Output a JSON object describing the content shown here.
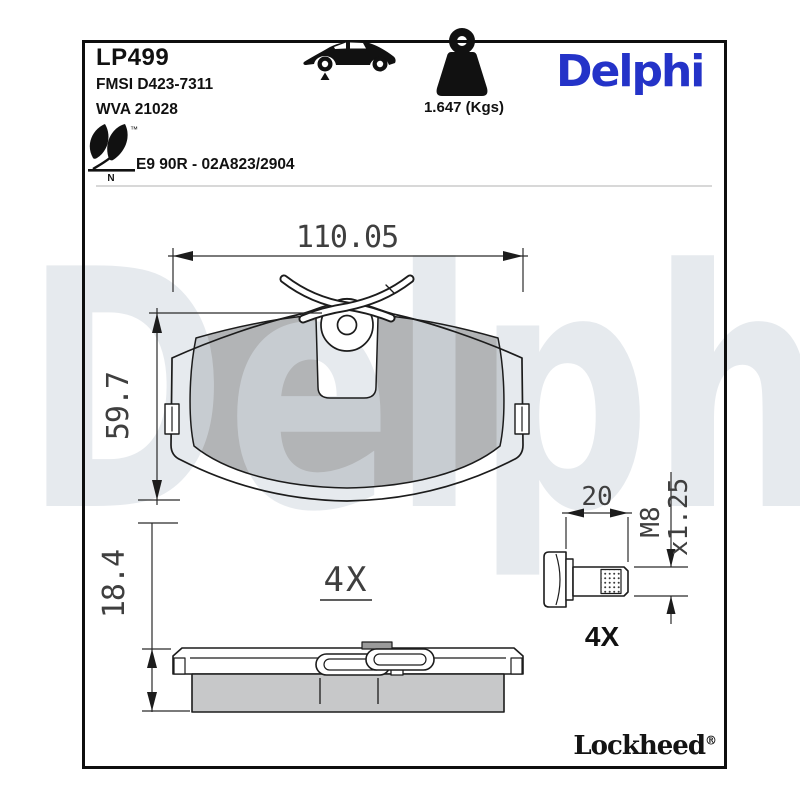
{
  "header": {
    "part_number": "LP499",
    "fmsi_code": "FMSI D423-7311",
    "wva_code": "WVA 21028",
    "weight": "1.647 (Kgs)",
    "homologation": "E9 90R - 02A823/2904",
    "eco_mark_letter": "N",
    "trademark_symbol": "™",
    "brand": "Delphi"
  },
  "drawing": {
    "watermark": "Delphi",
    "pad_front_view": {
      "width_mm": "110.05",
      "height_mm": "59.7",
      "quantity_label": "4X"
    },
    "pad_side_view": {
      "thickness_mm": "18.4"
    },
    "guide_bolt": {
      "length_mm": "20",
      "thread_size": "M8",
      "thread_pitch": "x1.25",
      "quantity_label": "4X"
    }
  },
  "footer": {
    "brand": "Lockheed",
    "registered_symbol": "®"
  },
  "icons": {
    "car": "car-silhouette-with-front-axle-marker",
    "weight": "weight-kettlebell",
    "eco": "eco-leaf-mark"
  },
  "colors": {
    "brand_blue": "#2433c8",
    "line_black": "#1c1c1c",
    "friction_gray": "#b2b4b6",
    "side_friction_gray": "#c7c8c9",
    "watermark": "#d6dce3"
  }
}
